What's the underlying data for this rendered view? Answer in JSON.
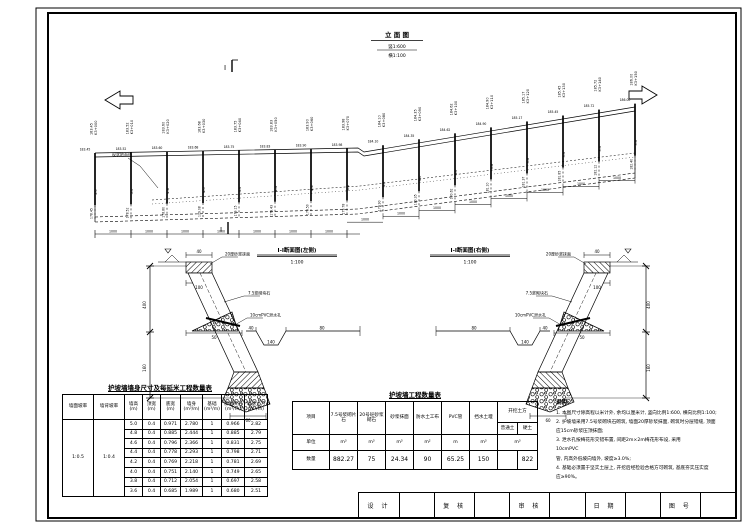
{
  "elevation": {
    "title": "立 面 图",
    "scale_top": "竖1:600",
    "scale_bottom": "横1:100",
    "section_mark": "Ⅰ",
    "ground_line_label": "现状地面线",
    "bay_dim": "1000",
    "posts": [
      {
        "station": "K3+000",
        "elev": "183.45",
        "h": "5.0"
      },
      {
        "station": "K3+010",
        "elev": "183.52",
        "h": "5.0"
      },
      {
        "station": "K3+020",
        "elev": "183.60",
        "h": "4.8"
      },
      {
        "station": "K3+030",
        "elev": "183.68",
        "h": "4.6"
      },
      {
        "station": "K3+040",
        "elev": "183.75",
        "h": "4.6"
      },
      {
        "station": "K3+050",
        "elev": "183.83",
        "h": "4.4"
      },
      {
        "station": "K3+060",
        "elev": "183.90",
        "h": "4.4"
      },
      {
        "station": "K3+070",
        "elev": "183.98",
        "h": "4.2"
      },
      {
        "station": "K3+080",
        "elev": "184.10",
        "h": "4.2"
      },
      {
        "station": "K3+090",
        "elev": "184.35",
        "h": "4.0"
      },
      {
        "station": "K3+100",
        "elev": "184.62",
        "h": "4.0"
      },
      {
        "station": "K3+110",
        "elev": "184.90",
        "h": "3.8"
      },
      {
        "station": "K3+120",
        "elev": "185.17",
        "h": "3.8"
      },
      {
        "station": "K3+130",
        "elev": "185.45",
        "h": "3.6"
      },
      {
        "station": "K3+140",
        "elev": "185.72",
        "h": "3.6"
      },
      {
        "station": "K3+150",
        "elev": "186.00",
        "h": "3.6"
      }
    ]
  },
  "sections": {
    "left_title": "Ⅰ-Ⅰ断面图(左侧)",
    "right_title": "Ⅰ-Ⅰ断面图(右侧)",
    "scale": "1:100",
    "labels": {
      "plaster": "20厚砂浆抹面",
      "masonry": "7.5浆砌块石",
      "weep": "10cmPVC泄水孔",
      "dim_top": "40",
      "dim_cap": "100",
      "dim_toe": "60",
      "dim_drain": "50",
      "dim_h1": "400",
      "dim_h2": "160",
      "dim_g1": "40",
      "dim_g2": "140",
      "dim_g3": "80"
    }
  },
  "wall_table": {
    "title": "护坡墙墙身尺寸及每延米工程数量表",
    "headers": [
      {
        "n": "墙面坡率",
        "u": ""
      },
      {
        "n": "墙背坡率",
        "u": ""
      },
      {
        "n": "墙高",
        "u": "(m)"
      },
      {
        "n": "顶宽",
        "u": "(m)"
      },
      {
        "n": "底宽",
        "u": "(m)"
      },
      {
        "n": "墙身",
        "u": "(m³/m)"
      },
      {
        "n": "基础",
        "u": "(m³/m)"
      },
      {
        "n": "浆砌块石",
        "u": "(m³/m)"
      },
      {
        "n": "墙基土方",
        "u": "(m³/m)"
      }
    ],
    "face_slope": "1:0.5",
    "back_slope": "1:0.4",
    "rows": [
      [
        "5.0",
        "0.4",
        "0.971",
        "2.780",
        "1",
        "0.966",
        "2.82"
      ],
      [
        "4.8",
        "0.4",
        "0.885",
        "2.444",
        "1",
        "0.885",
        "2.79"
      ],
      [
        "4.6",
        "0.4",
        "0.796",
        "2.366",
        "1",
        "0.831",
        "2.75"
      ],
      [
        "4.4",
        "0.4",
        "0.778",
        "2.293",
        "1",
        "0.798",
        "2.71"
      ],
      [
        "4.2",
        "0.4",
        "0.769",
        "2.218",
        "1",
        "0.781",
        "2.69"
      ],
      [
        "4.0",
        "0.4",
        "0.751",
        "2.140",
        "1",
        "0.749",
        "2.65"
      ],
      [
        "3.8",
        "0.4",
        "0.712",
        "2.054",
        "1",
        "0.697",
        "2.58"
      ],
      [
        "3.6",
        "0.4",
        "0.685",
        "1.989",
        "1",
        "0.680",
        "2.51"
      ]
    ]
  },
  "qty_table": {
    "title": "护坡墙工程数量表",
    "row_labels": {
      "item": "项目",
      "unit": "单位",
      "qty": "数量"
    },
    "columns": [
      {
        "name": "7.5号浆砌片石",
        "unit": "m³",
        "qty": "882.27"
      },
      {
        "name": "20号砼砂浆砌石",
        "unit": "m³",
        "qty": "75"
      },
      {
        "name": "砂浆抹面",
        "unit": "m³",
        "qty": "24.34"
      },
      {
        "name": "防水土工布",
        "unit": "m²",
        "qty": "90"
      },
      {
        "name": "PVC管",
        "unit": "m",
        "qty": "65.25"
      },
      {
        "name": "挡水土堰",
        "unit": "m³",
        "qty": "150"
      }
    ],
    "excavation": {
      "name": "开挖土方",
      "sub1": "普通土",
      "sub2": "硬土",
      "unit": "m³",
      "qty1": "",
      "qty2": "822"
    }
  },
  "notes": {
    "title": "说明:",
    "lines": [
      "1. 本图尺寸除高程以米计外, 余均以厘米计, 竖向比例1:600, 横向比例1:100;",
      "2. 护坡墙采用7.5号浆砌块石砌筑, 墙面20厚砂浆抹面, 砌筑时分层错缝, 顶面",
      "    应15cm砂浆压顶抹面;",
      "3. 泄水孔按梅花形交错布置, 间距2m×2m梅花形布设, 采用",
      "10cmPVC",
      "    管, 内高外低坡向墙外, 坡度≥3.0%;",
      "4. 基础必须置于坚实土层上, 开挖后经检验合格方可砌筑, 基底夯实压实度",
      "    应≥90%。"
    ]
  },
  "titleblock": {
    "design": "设 计",
    "check": "复 核",
    "review": "审 核",
    "date": "日 期",
    "number": "图 号"
  }
}
